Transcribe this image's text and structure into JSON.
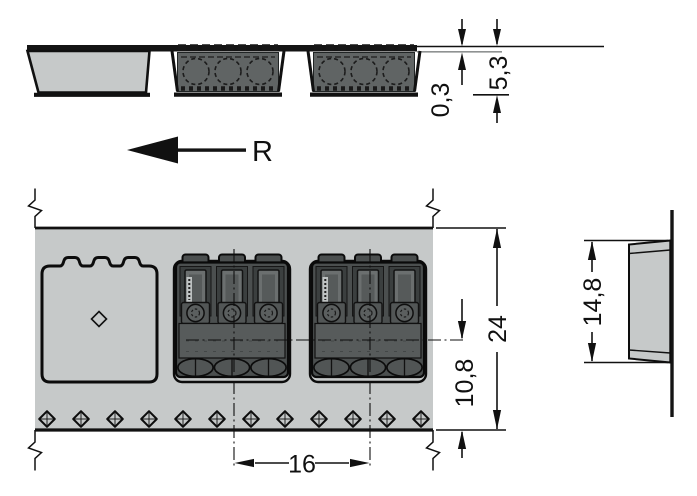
{
  "colors": {
    "tape": "#c6c9c9",
    "component": "#4b4f4f",
    "line": "#111111"
  },
  "views": {
    "side": {
      "dims": {
        "tape_thickness": "0,3",
        "pocket_depth": "5,3"
      }
    },
    "direction": {
      "label": "R"
    },
    "plan": {
      "dims": {
        "tape_width": "24",
        "centerline_to_edge": "10,8",
        "pocket_pitch": "16"
      }
    },
    "end": {
      "dims": {
        "pocket_height": "14,8"
      }
    }
  }
}
